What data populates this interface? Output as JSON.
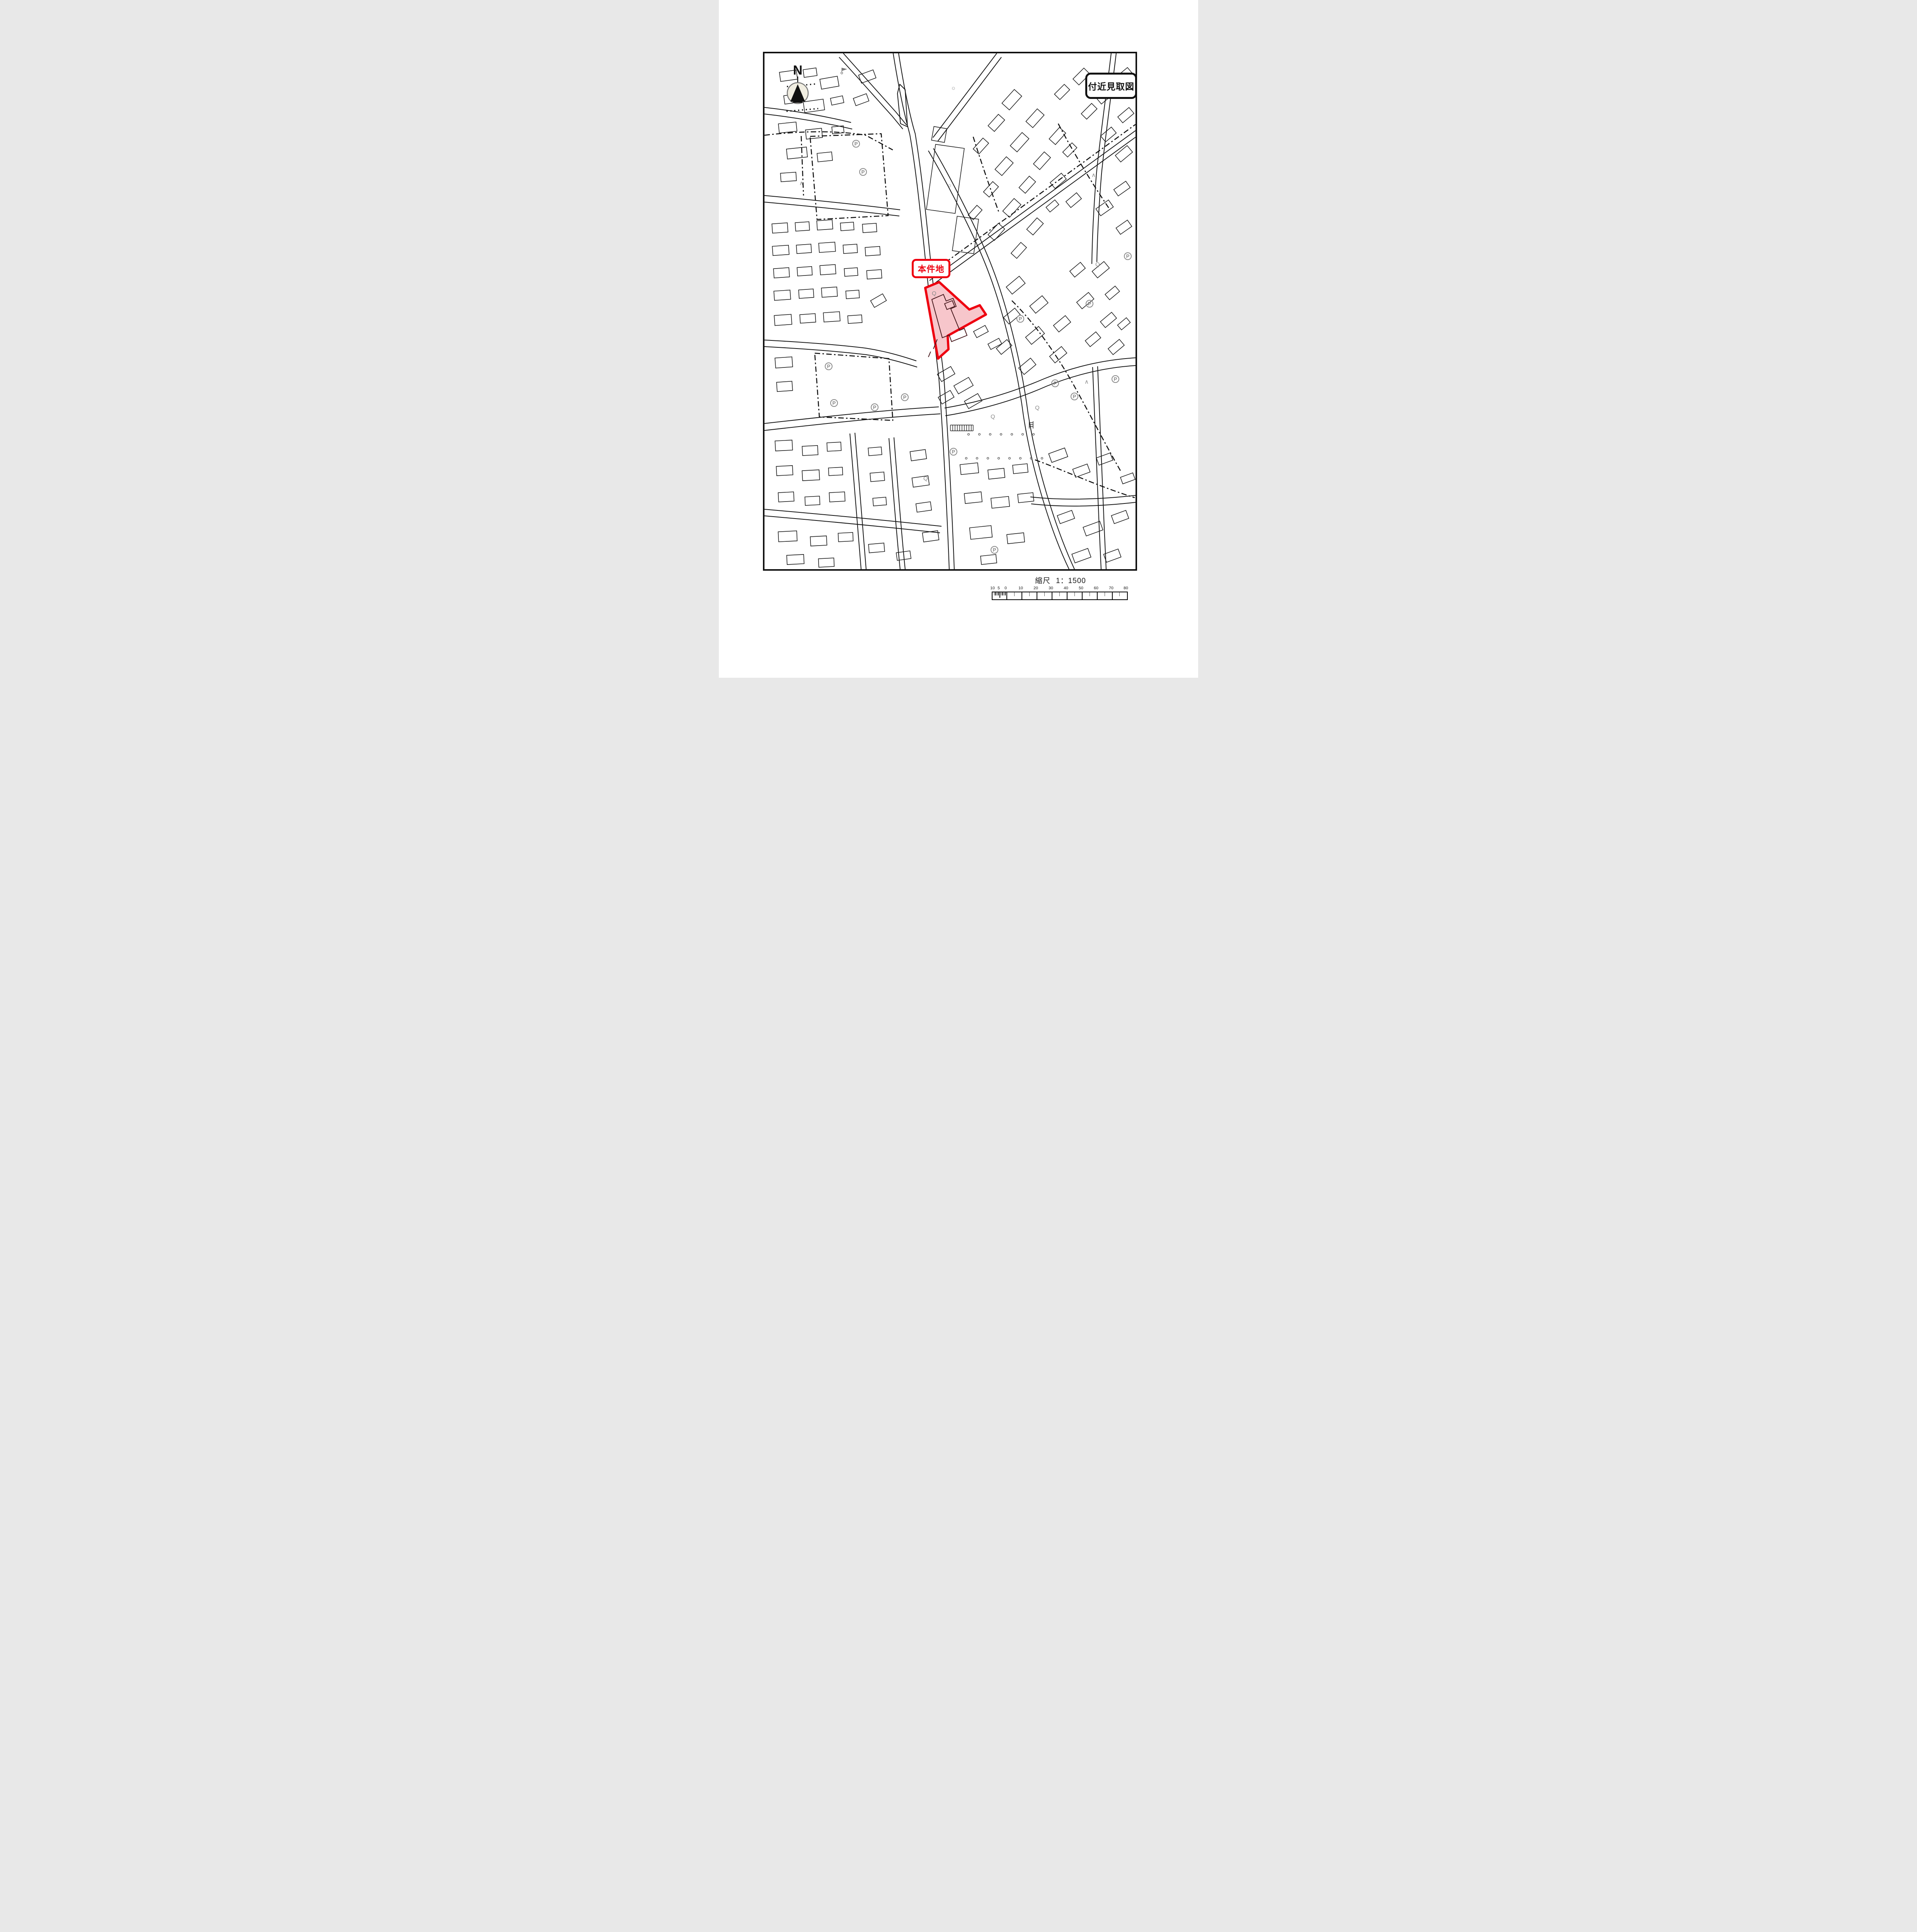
{
  "page": {
    "background": "#ffffff",
    "map_line_color": "#141414",
    "accent_red": "#ee0010",
    "parcel_fill": "#f7c6cb"
  },
  "title_box": {
    "label": "付近見取図"
  },
  "north_indicator": {
    "label": "N"
  },
  "site_label": {
    "label": "本件地"
  },
  "scale_caption": {
    "label": "縮尺",
    "ratio": "1：1500"
  },
  "scale_bar": {
    "labels": [
      "10",
      "5",
      "0",
      "10",
      "20",
      "30",
      "40",
      "50",
      "60",
      "70",
      "80"
    ],
    "meters_per_division": 10
  },
  "map_symbols": {
    "parking": "P",
    "q_mark": "Q",
    "sun_mark": "☼",
    "caret_mark": "∧"
  }
}
